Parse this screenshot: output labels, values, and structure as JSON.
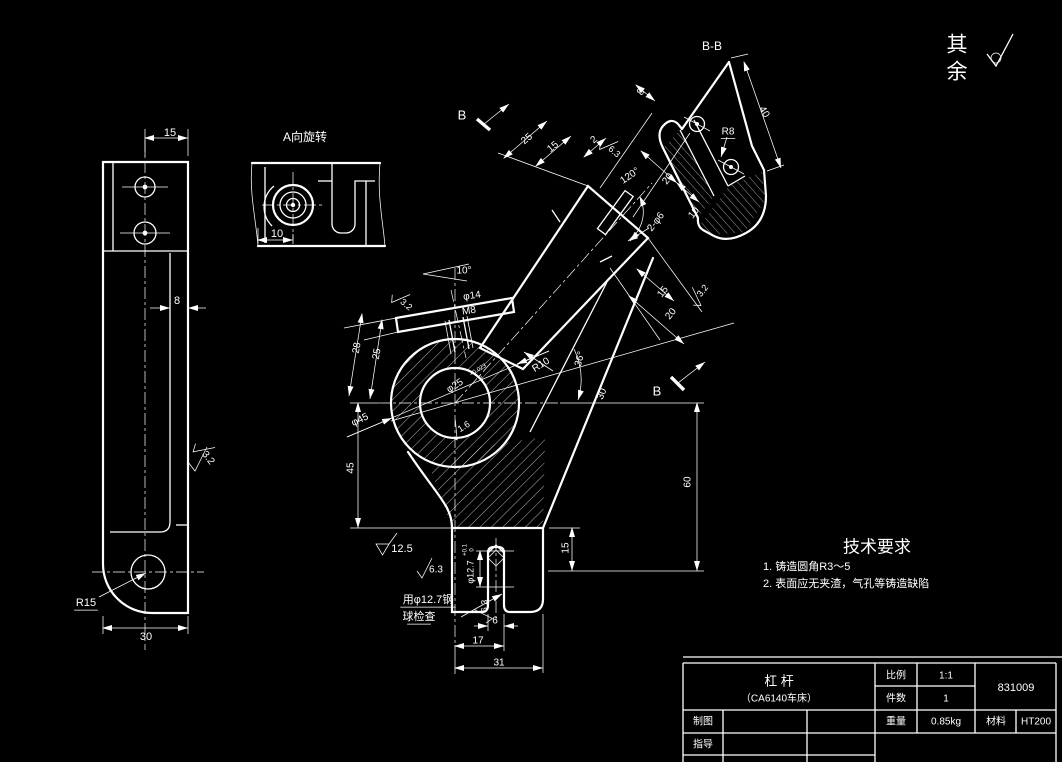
{
  "app": {
    "type": "cad-engineering-drawing",
    "background": "#000000",
    "line_color": "#ffffff"
  },
  "corner_note": {
    "char1": "其",
    "char2": "余",
    "symbol": "surface-roughness-any"
  },
  "tech_requirements": {
    "title": "技术要求",
    "items": [
      "1. 铸造圆角R3～5",
      "2. 表面应无夹渣，气孔等铸造缺陷"
    ]
  },
  "views": {
    "aux_view": {
      "title": "A向旋转"
    },
    "section_view": {
      "title": "B-B"
    }
  },
  "title_block": {
    "part_name": "杠  杆",
    "part_model": "（CA6140车床）",
    "scale_label": "比例",
    "scale_value": "1:1",
    "qty_label": "件数",
    "qty_value": "1",
    "drawing_number": "831009",
    "drawn_by_label": "制图",
    "weight_label": "重量",
    "weight_value": "0.85kg",
    "material_label": "材料",
    "material_value": "HT200",
    "advisor_label": "指导"
  },
  "annotations": [
    {
      "name": "dimension-label",
      "t": "15",
      "x": 170,
      "y": 133,
      "s": 11
    },
    {
      "name": "dimension-label",
      "t": "8",
      "x": 177,
      "y": 301,
      "s": 11
    },
    {
      "name": "roughness-label",
      "t": "3.2",
      "x": 208,
      "y": 458,
      "s": 10,
      "r": 52
    },
    {
      "name": "radius-label",
      "t": "R15",
      "x": 86,
      "y": 603,
      "s": 11,
      "ul": 1
    },
    {
      "name": "dimension-label",
      "t": "30",
      "x": 146,
      "y": 637,
      "s": 11
    },
    {
      "name": "dimension-label",
      "t": "10",
      "x": 277,
      "y": 234,
      "s": 11
    },
    {
      "name": "dimension-label",
      "t": "8",
      "x": 641,
      "y": 92,
      "s": 10,
      "r": -52
    },
    {
      "name": "dimension-label",
      "t": "40",
      "x": 764,
      "y": 112,
      "s": 10,
      "r": 60
    },
    {
      "name": "radius-label",
      "t": "R8",
      "x": 728,
      "y": 132,
      "s": 10,
      "ul": 1
    },
    {
      "name": "section-label",
      "t": "B",
      "x": 462,
      "y": 116,
      "s": 13
    },
    {
      "name": "section-label",
      "t": "B",
      "x": 657,
      "y": 392,
      "s": 13
    },
    {
      "name": "dimension-label",
      "t": "25",
      "x": 527,
      "y": 139,
      "s": 10,
      "r": -40
    },
    {
      "name": "dimension-label",
      "t": "15",
      "x": 553,
      "y": 147,
      "s": 10,
      "r": -40
    },
    {
      "name": "dimension-label",
      "t": "2",
      "x": 594,
      "y": 140,
      "s": 10,
      "r": -40
    },
    {
      "name": "roughness-label",
      "t": "6.3",
      "x": 614,
      "y": 152,
      "s": 9,
      "r": 40
    },
    {
      "name": "dimension-label",
      "t": "120°",
      "x": 630,
      "y": 176,
      "s": 10,
      "r": -35
    },
    {
      "name": "dimension-label",
      "t": "20",
      "x": 668,
      "y": 179,
      "s": 10,
      "r": -52
    },
    {
      "name": "dimension-label",
      "t": "10",
      "x": 694,
      "y": 213,
      "s": 10,
      "r": -52
    },
    {
      "name": "dimension-label",
      "t": "2-φ6",
      "x": 656,
      "y": 222,
      "s": 10,
      "r": -52
    },
    {
      "name": "dimension-label",
      "t": "15",
      "x": 663,
      "y": 292,
      "s": 10,
      "r": -52
    },
    {
      "name": "dimension-label",
      "t": "20",
      "x": 671,
      "y": 314,
      "s": 10,
      "r": -52
    },
    {
      "name": "roughness-label",
      "t": "3.2",
      "x": 703,
      "y": 291,
      "s": 9,
      "r": -52
    },
    {
      "name": "roughness-label",
      "t": "3.2",
      "x": 406,
      "y": 305,
      "s": 9,
      "r": 40
    },
    {
      "name": "dimension-label",
      "t": "10°",
      "x": 464,
      "y": 271,
      "s": 10
    },
    {
      "name": "dimension-label",
      "t": "φ14",
      "x": 472,
      "y": 296,
      "s": 10,
      "r": -8
    },
    {
      "name": "thread-label",
      "t": "M8",
      "x": 469,
      "y": 311,
      "s": 10,
      "r": -8
    },
    {
      "name": "dimension-label",
      "t": "28",
      "x": 357,
      "y": 348,
      "s": 10,
      "r": -80
    },
    {
      "name": "dimension-label",
      "t": "25",
      "x": 377,
      "y": 354,
      "s": 10,
      "r": -80
    },
    {
      "name": "dimension-label",
      "t": "φ45",
      "x": 360,
      "y": 420,
      "s": 10,
      "r": -25
    },
    {
      "name": "dimension-label",
      "t": "φ25",
      "x": 455,
      "y": 386,
      "s": 10,
      "r": -32
    },
    {
      "name": "tolerance-label",
      "t": "+0.023",
      "x": 478,
      "y": 370,
      "s": 6,
      "r": -32
    },
    {
      "name": "tolerance-label",
      "t": "0",
      "x": 481,
      "y": 378,
      "s": 6,
      "r": -32
    },
    {
      "name": "roughness-label",
      "t": "1.6",
      "x": 464,
      "y": 427,
      "s": 9,
      "r": -32
    },
    {
      "name": "radius-label",
      "t": "R10",
      "x": 541,
      "y": 365,
      "s": 10,
      "r": -32
    },
    {
      "name": "dimension-label",
      "t": "36°",
      "x": 580,
      "y": 359,
      "s": 10,
      "r": -75
    },
    {
      "name": "dimension-label",
      "t": "30",
      "x": 602,
      "y": 394,
      "s": 10,
      "r": -68
    },
    {
      "name": "dimension-label",
      "t": "60",
      "x": 688,
      "y": 482,
      "s": 10,
      "r": -90
    },
    {
      "name": "dimension-label",
      "t": "45",
      "x": 351,
      "y": 468,
      "s": 10,
      "r": -90
    },
    {
      "name": "roughness-cast-label",
      "t": "12.5",
      "x": 402,
      "y": 549,
      "s": 11
    },
    {
      "name": "roughness-label",
      "t": "6.3",
      "x": 436,
      "y": 570,
      "s": 10
    },
    {
      "name": "dimension-label",
      "t": "φ12.7",
      "x": 471,
      "y": 572,
      "s": 9,
      "r": -90
    },
    {
      "name": "tolerance-label",
      "t": "+0.1",
      "x": 465,
      "y": 550,
      "s": 6,
      "r": -90
    },
    {
      "name": "tolerance-label",
      "t": "0",
      "x": 472,
      "y": 550,
      "s": 6,
      "r": -90
    },
    {
      "name": "note-label",
      "t": "用φ12.7钢",
      "x": 428,
      "y": 600,
      "s": 11,
      "ul": 1
    },
    {
      "name": "note-label",
      "t": "球检查",
      "x": 419,
      "y": 617,
      "s": 11,
      "ul": 1
    },
    {
      "name": "roughness-label",
      "t": "6.3",
      "x": 485,
      "y": 606,
      "s": 9,
      "r": -90
    },
    {
      "name": "dimension-label",
      "t": "6",
      "x": 495,
      "y": 621,
      "s": 10
    },
    {
      "name": "dimension-label",
      "t": "17",
      "x": 478,
      "y": 641,
      "s": 10
    },
    {
      "name": "dimension-label",
      "t": "31",
      "x": 499,
      "y": 663,
      "s": 10
    },
    {
      "name": "dimension-label",
      "t": "15",
      "x": 566,
      "y": 548,
      "s": 10,
      "r": -90
    }
  ]
}
